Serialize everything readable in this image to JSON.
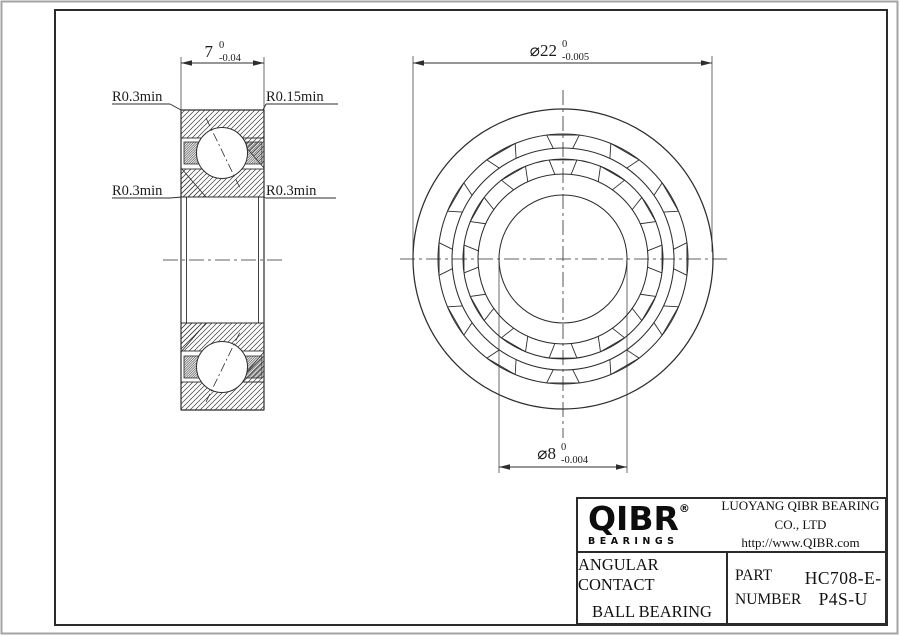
{
  "drawing": {
    "line_color": "#2d2d2d",
    "section_view": {
      "width_dim": {
        "value": "7",
        "tol_upper": "0",
        "tol_lower": "-0.04"
      },
      "corner_labels": {
        "top_left": "R0.3min",
        "top_right": "R0.15min",
        "mid_left": "R0.3min",
        "mid_right": "R0.3min"
      }
    },
    "front_view": {
      "outer_dia_dim": {
        "value": "⌀22",
        "tol_upper": "0",
        "tol_lower": "-0.005"
      },
      "bore_dia_dim": {
        "value": "⌀8",
        "tol_upper": "0",
        "tol_lower": "-0.004"
      },
      "circle_radii_px": [
        150,
        125,
        111,
        100,
        85,
        64
      ],
      "pocket_count_per_row": 12
    }
  },
  "title_block": {
    "logo": {
      "text": "QIBR",
      "registered_mark": "®",
      "subtext": "BEARINGS"
    },
    "company": "LUOYANG QIBR BEARING CO., LTD",
    "website": "http://www.QIBR.com",
    "product": {
      "line1": "ANGULAR CONTACT",
      "line2": "BALL BEARING"
    },
    "part_label": {
      "line1": "PART",
      "line2": "NUMBER"
    },
    "part_number": "HC708-E-P4S-U"
  }
}
